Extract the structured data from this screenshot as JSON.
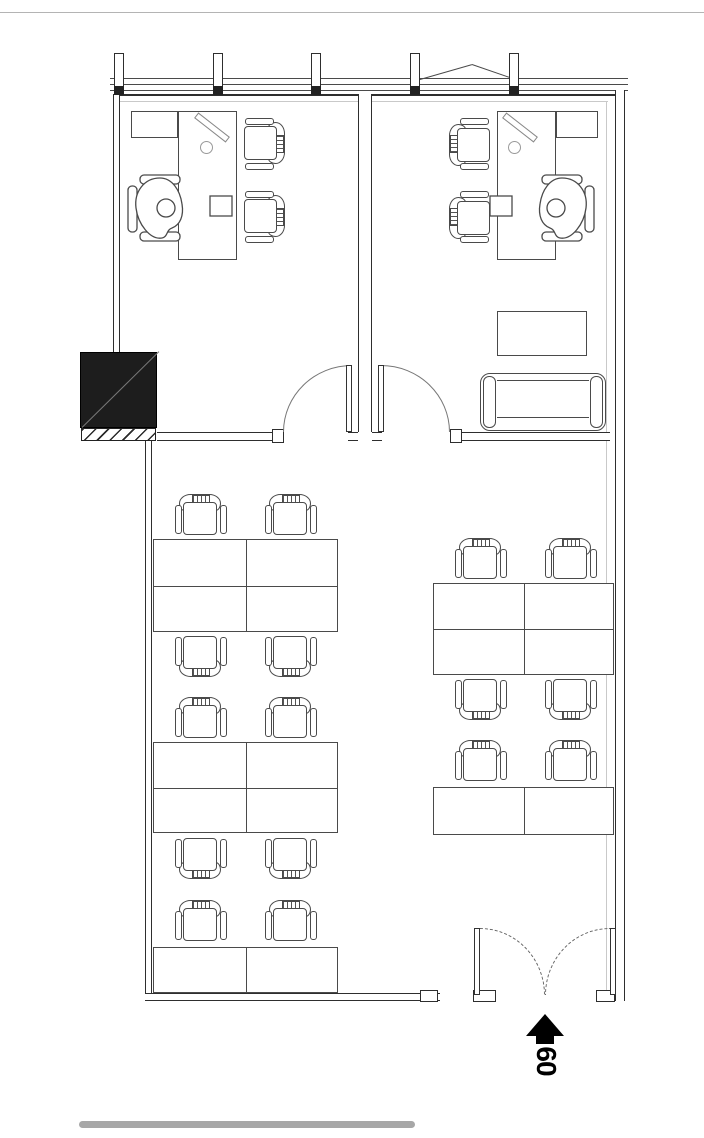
{
  "plan": {
    "entrance_label": "60",
    "canvas": {
      "w": 704,
      "h": 1138,
      "bg": "#ffffff"
    },
    "colors": {
      "line": "#4a4a4a",
      "wall": "#2e2e2e",
      "light": "#c9c9c9",
      "arc": "#777777",
      "shaft_fill": "#1d1d1d",
      "shaft_diag": "#787878",
      "scalebar": "#a7a7a7",
      "label": "#000000"
    },
    "lines": [
      {
        "x": 0,
        "y": 12,
        "w": 704,
        "h": 1,
        "c": "#b4b4b4"
      },
      {
        "x": 110,
        "y": 78,
        "w": 518,
        "h": 1,
        "c": "#4a4a4a"
      },
      {
        "x": 110,
        "y": 84,
        "w": 518,
        "h": 1,
        "c": "#4a4a4a"
      },
      {
        "x": 110,
        "y": 90,
        "w": 518,
        "h": 1,
        "c": "#4a4a4a"
      },
      {
        "x": 113,
        "y": 94,
        "w": 512,
        "h": 2,
        "c": "#2e2e2e"
      },
      {
        "x": 120,
        "y": 101,
        "w": 488,
        "h": 1,
        "c": "#c9c9c9"
      },
      {
        "x": 606,
        "y": 101,
        "w": 1,
        "h": 890,
        "c": "#c9c9c9"
      },
      {
        "x": 178,
        "y": 252,
        "w": 59,
        "h": 1,
        "c": "#4a4a4a"
      },
      {
        "x": 497,
        "y": 252,
        "w": 59,
        "h": 1,
        "c": "#4a4a4a"
      }
    ],
    "slanted_lines": [
      {
        "x": 420,
        "y": 79,
        "len": 54,
        "ang": -16
      },
      {
        "x": 472,
        "y": 64,
        "len": 47,
        "ang": 19
      }
    ],
    "double_walls": [
      {
        "x": 113,
        "y": 94,
        "w": 7,
        "h": 258,
        "o": "v"
      },
      {
        "x": 358,
        "y": 94,
        "w": 14,
        "h": 338,
        "o": "v"
      },
      {
        "x": 615,
        "y": 90,
        "w": 10,
        "h": 911,
        "o": "v"
      },
      {
        "x": 145,
        "y": 441,
        "w": 7,
        "h": 560,
        "o": "v"
      },
      {
        "x": 157,
        "y": 432,
        "w": 115,
        "h": 9,
        "o": "h"
      },
      {
        "x": 348,
        "y": 432,
        "w": 10,
        "h": 9,
        "o": "h"
      },
      {
        "x": 372,
        "y": 432,
        "w": 10,
        "h": 9,
        "o": "h"
      },
      {
        "x": 450,
        "y": 432,
        "w": 160,
        "h": 9,
        "o": "h"
      },
      {
        "x": 145,
        "y": 993,
        "w": 295,
        "h": 8,
        "o": "h"
      }
    ],
    "mullions": [
      {
        "x": 114,
        "y": 53,
        "w": 10,
        "h": 39
      },
      {
        "x": 213,
        "y": 53,
        "w": 10,
        "h": 39
      },
      {
        "x": 311,
        "y": 53,
        "w": 10,
        "h": 39
      },
      {
        "x": 410,
        "y": 53,
        "w": 10,
        "h": 39
      },
      {
        "x": 509,
        "y": 53,
        "w": 10,
        "h": 39
      }
    ],
    "connectors": [
      {
        "x": 114,
        "y": 86,
        "w": 10,
        "h": 9
      },
      {
        "x": 213,
        "y": 86,
        "w": 10,
        "h": 9
      },
      {
        "x": 311,
        "y": 86,
        "w": 10,
        "h": 9
      },
      {
        "x": 410,
        "y": 86,
        "w": 10,
        "h": 9
      },
      {
        "x": 509,
        "y": 86,
        "w": 10,
        "h": 9
      }
    ],
    "jambs": [
      {
        "x": 272,
        "y": 429,
        "w": 12,
        "h": 14
      },
      {
        "x": 450,
        "y": 429,
        "w": 12,
        "h": 14
      },
      {
        "x": 420,
        "y": 990,
        "w": 18,
        "h": 12
      },
      {
        "x": 473,
        "y": 990,
        "w": 23,
        "h": 12
      },
      {
        "x": 596,
        "y": 990,
        "w": 19,
        "h": 12
      }
    ],
    "furniture_rects": [
      {
        "x": 131,
        "y": 111,
        "w": 47,
        "h": 27,
        "n": "return-cabinet"
      },
      {
        "x": 556,
        "y": 111,
        "w": 42,
        "h": 27,
        "n": "return-cabinet"
      },
      {
        "x": 178,
        "y": 111,
        "w": 59,
        "h": 149,
        "n": "office-desk"
      },
      {
        "x": 497,
        "y": 111,
        "w": 59,
        "h": 149,
        "n": "office-desk"
      },
      {
        "x": 497,
        "y": 311,
        "w": 90,
        "h": 45,
        "n": "side-table"
      }
    ],
    "desk_blocks": [
      {
        "x": 153,
        "y": 539,
        "w": 185,
        "h": 93,
        "vx": 1,
        "hy": 1
      },
      {
        "x": 153,
        "y": 742,
        "w": 185,
        "h": 91,
        "vx": 1,
        "hy": 1
      },
      {
        "x": 153,
        "y": 947,
        "w": 185,
        "h": 46,
        "vx": 1,
        "hy": 0
      },
      {
        "x": 433,
        "y": 583,
        "w": 181,
        "h": 92,
        "vx": 1,
        "hy": 1
      },
      {
        "x": 433,
        "y": 787,
        "w": 181,
        "h": 48,
        "vx": 1,
        "hy": 0
      }
    ],
    "chairs": [
      {
        "x": 175,
        "y": 494,
        "d": "down"
      },
      {
        "x": 265,
        "y": 494,
        "d": "down"
      },
      {
        "x": 175,
        "y": 633,
        "d": "up"
      },
      {
        "x": 265,
        "y": 633,
        "d": "up"
      },
      {
        "x": 175,
        "y": 697,
        "d": "down"
      },
      {
        "x": 265,
        "y": 697,
        "d": "down"
      },
      {
        "x": 175,
        "y": 835,
        "d": "up"
      },
      {
        "x": 265,
        "y": 835,
        "d": "up"
      },
      {
        "x": 175,
        "y": 900,
        "d": "down"
      },
      {
        "x": 265,
        "y": 900,
        "d": "down"
      },
      {
        "x": 455,
        "y": 538,
        "d": "down"
      },
      {
        "x": 545,
        "y": 538,
        "d": "down"
      },
      {
        "x": 455,
        "y": 676,
        "d": "up"
      },
      {
        "x": 545,
        "y": 676,
        "d": "up"
      },
      {
        "x": 455,
        "y": 740,
        "d": "down"
      },
      {
        "x": 545,
        "y": 740,
        "d": "down"
      },
      {
        "x": 237,
        "y": 122,
        "d": "left"
      },
      {
        "x": 237,
        "y": 195,
        "d": "left"
      },
      {
        "x": 445,
        "y": 122,
        "d": "right"
      },
      {
        "x": 445,
        "y": 195,
        "d": "right"
      }
    ],
    "exec_chairs": [
      {
        "x": 122,
        "y": 166,
        "flip": 0
      },
      {
        "x": 488,
        "y": 166,
        "flip": 1
      }
    ],
    "monitors": [
      {
        "x": 192,
        "y": 124
      },
      {
        "x": 500,
        "y": 124
      }
    ],
    "door_arcs": [
      {
        "x": 283,
        "y": 365,
        "w": 69,
        "h": 67,
        "corner": "tl",
        "dash": 0
      },
      {
        "x": 381,
        "y": 365,
        "w": 69,
        "h": 67,
        "corner": "tr",
        "dash": 0
      },
      {
        "x": 480,
        "y": 928,
        "w": 65,
        "h": 67,
        "corner": "tr",
        "dash": 1
      },
      {
        "x": 545,
        "y": 928,
        "w": 65,
        "h": 67,
        "corner": "tl",
        "dash": 1
      }
    ],
    "door_leaves": [
      {
        "x": 346,
        "y": 365,
        "w": 6,
        "h": 67
      },
      {
        "x": 378,
        "y": 365,
        "w": 6,
        "h": 67
      },
      {
        "x": 474,
        "y": 928,
        "w": 6,
        "h": 67
      },
      {
        "x": 610,
        "y": 928,
        "w": 6,
        "h": 67
      }
    ],
    "shaft": {
      "x": 80,
      "y": 352,
      "w": 77,
      "h": 76
    },
    "hatch": {
      "x": 81,
      "y": 428,
      "w": 75,
      "h": 13
    },
    "sofa": {
      "x": 480,
      "y": 373,
      "w": 126,
      "h": 58
    },
    "scale_bar": {
      "x": 79,
      "y": 1121,
      "w": 336,
      "h": 7
    }
  }
}
